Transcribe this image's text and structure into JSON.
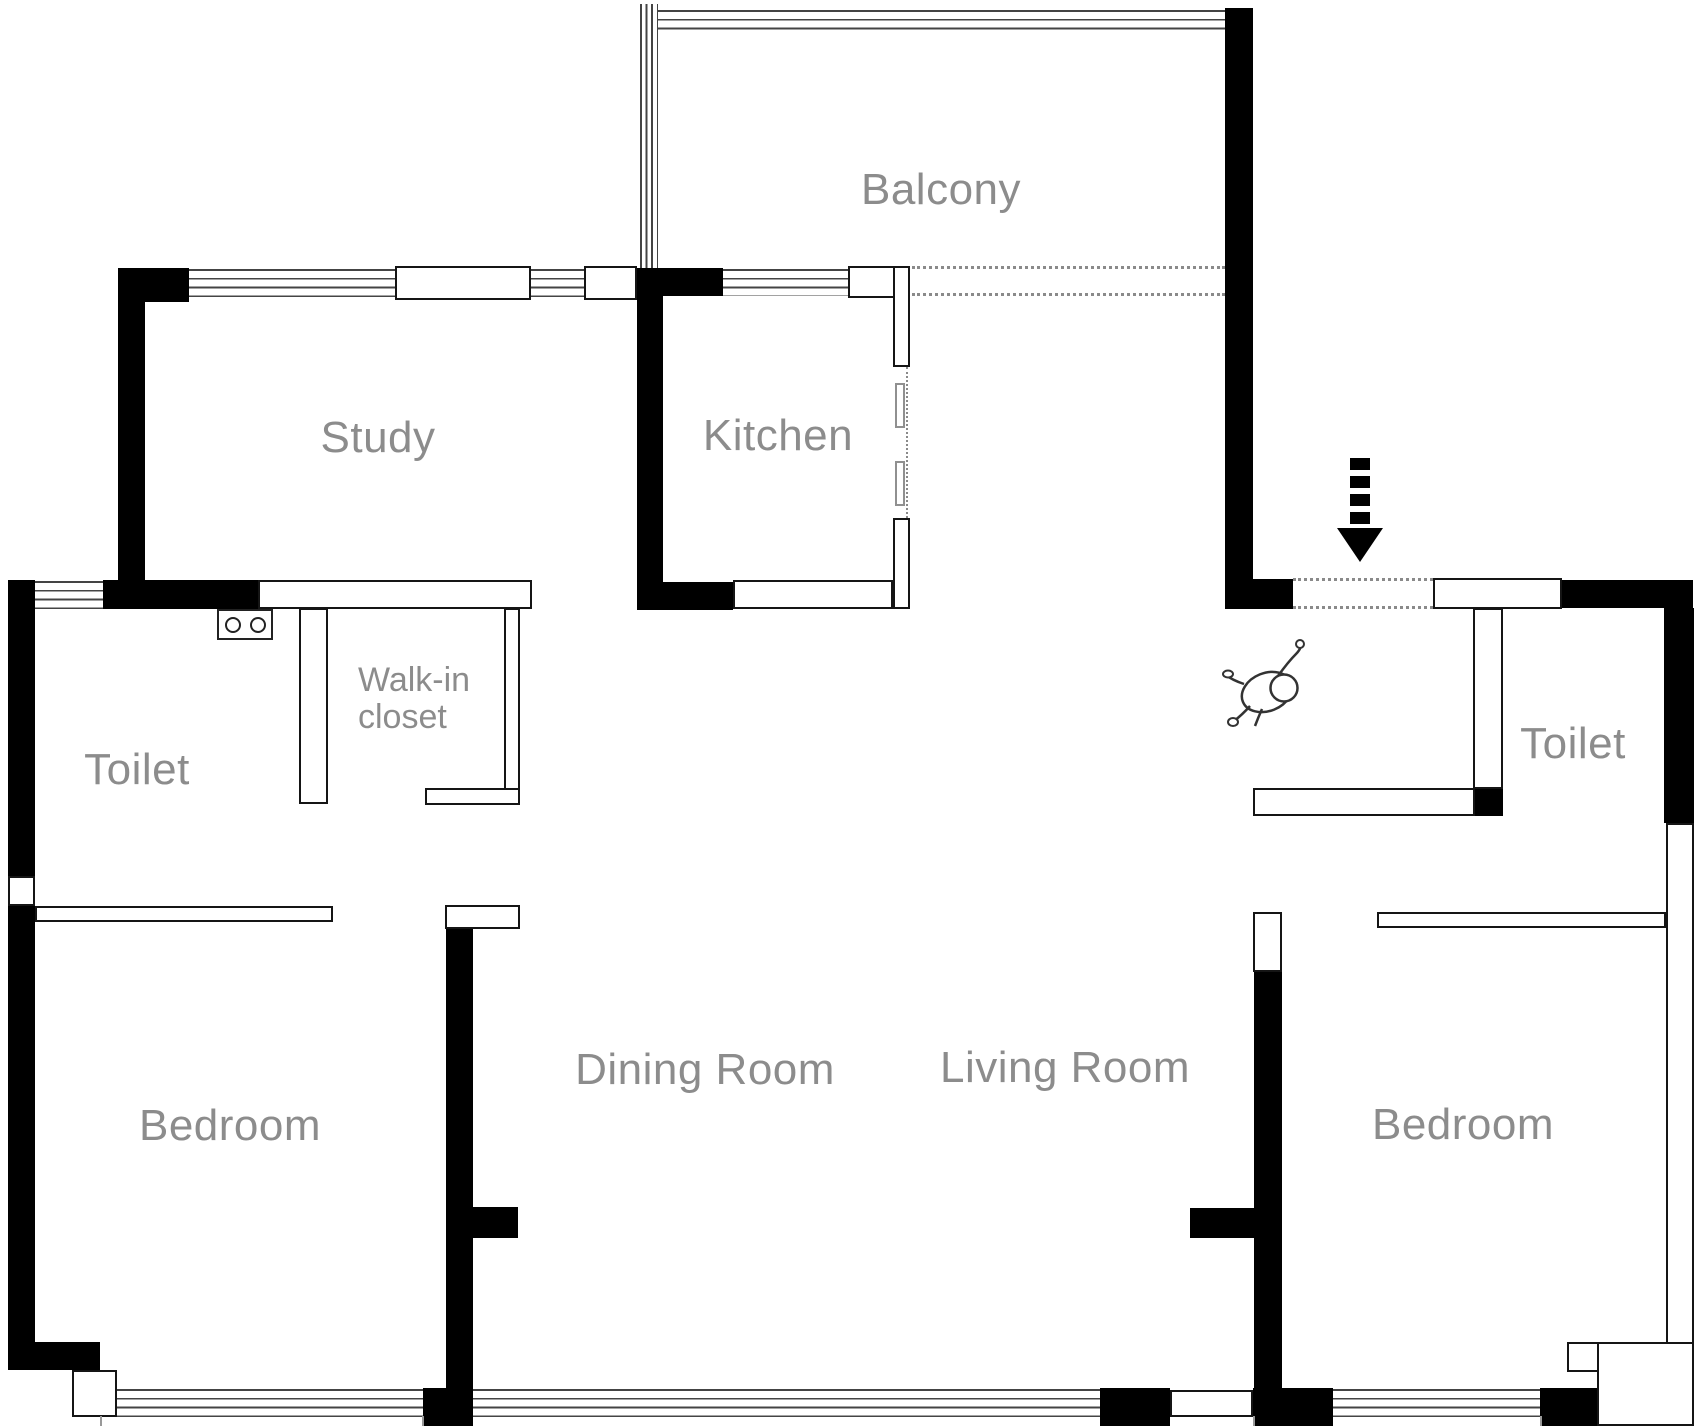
{
  "rooms": {
    "balcony": "Balcony",
    "study": "Study",
    "kitchen": "Kitchen",
    "toilet_left": "Toilet",
    "walk_in_closet_line1": "Walk-in",
    "walk_in_closet_line2": "closet",
    "bedroom_left": "Bedroom",
    "dining_room": "Dining Room",
    "living_room": "Living Room",
    "bedroom_right": "Bedroom",
    "toilet_right": "Toilet"
  },
  "icons": {
    "entrance_arrow": "entrance-direction-arrow",
    "person_figure": "person-top-view-figure",
    "sink": "double-basin-sink",
    "sliding_door": "kitchen-sliding-door"
  },
  "colors": {
    "wall": "#000000",
    "wall_outline": "#151515",
    "label_text": "#8c8c8c",
    "window_line": "#444444",
    "dotted_line": "#8a8a8a",
    "background": "#ffffff"
  }
}
